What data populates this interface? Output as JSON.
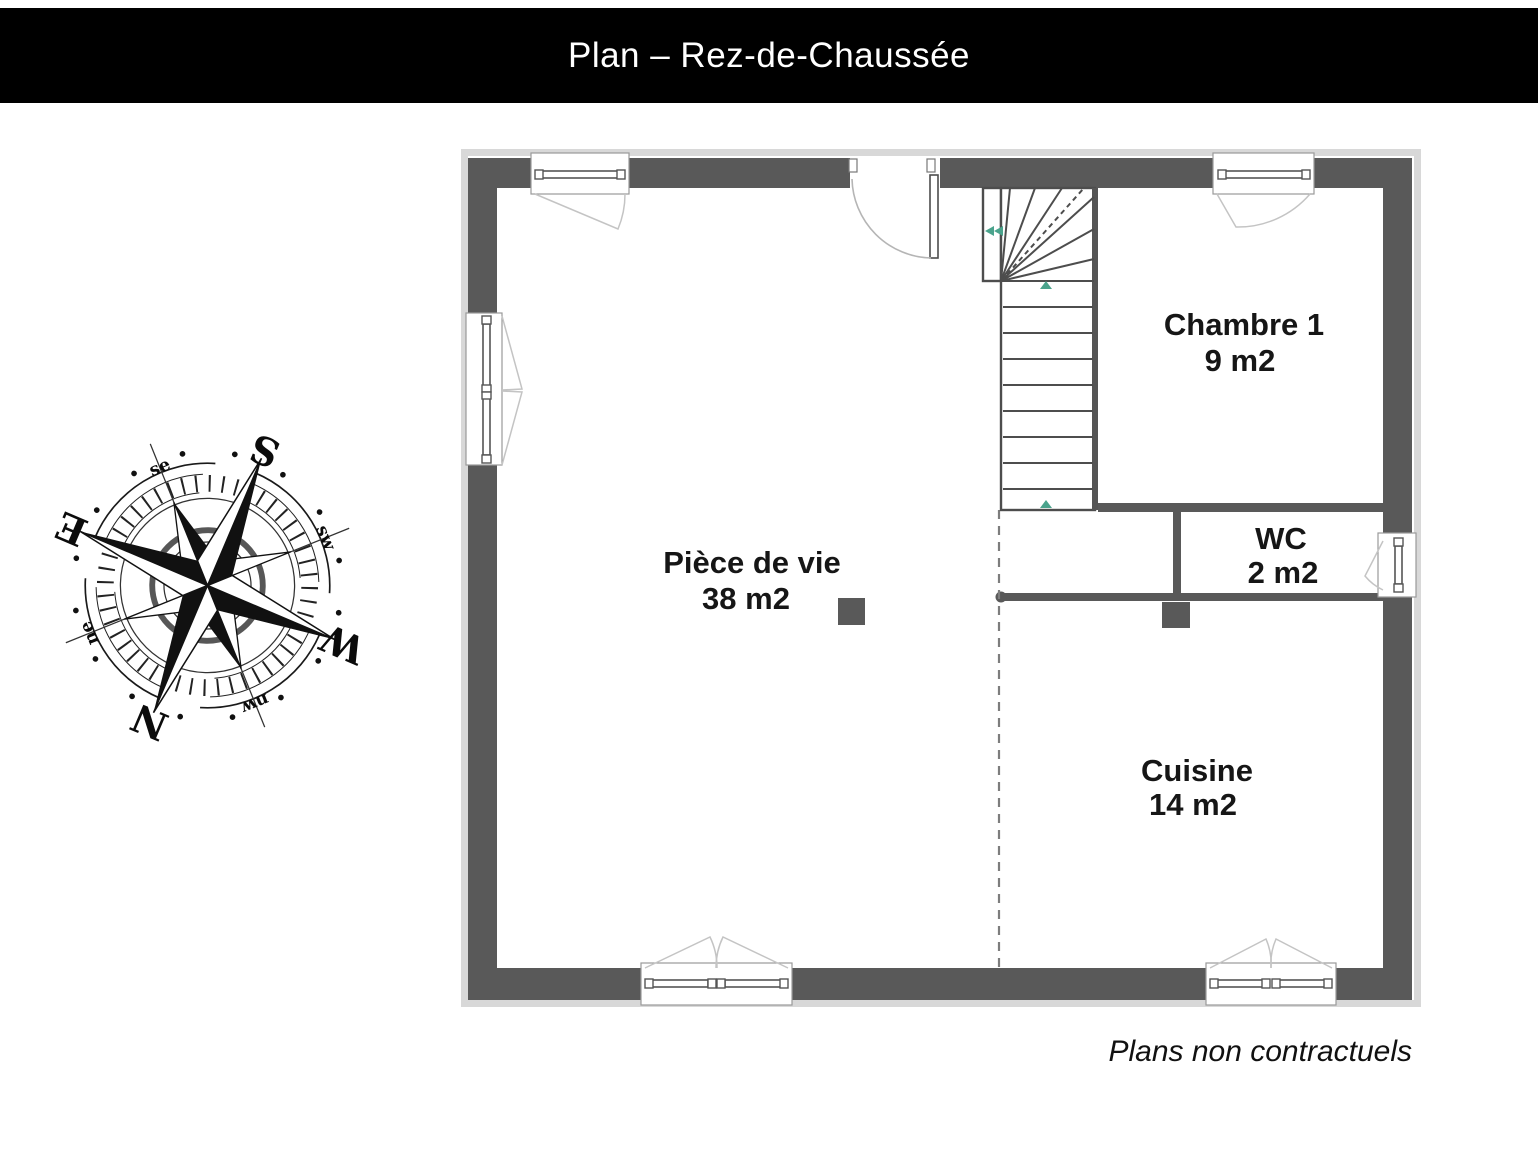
{
  "header": {
    "title": "Plan – Rez-de-Chaussée"
  },
  "compass": {
    "rotation_deg": 203,
    "cardinals": {
      "n": "N",
      "s": "S",
      "e": "E",
      "w": "W"
    },
    "intercardinals": {
      "ne": "ne",
      "se": "se",
      "sw": "sw",
      "nw": "nw"
    }
  },
  "rooms": [
    {
      "id": "piece-de-vie",
      "name": "Pièce de vie",
      "area": "38 m2"
    },
    {
      "id": "chambre-1",
      "name": "Chambre 1",
      "area": "9 m2"
    },
    {
      "id": "wc",
      "name": "WC",
      "area": "2 m2"
    },
    {
      "id": "cuisine",
      "name": "Cuisine",
      "area": "14 m2"
    }
  ],
  "footer": {
    "disclaimer": "Plans non contractuels"
  },
  "colors": {
    "header_bg": "#000000",
    "header_text": "#ffffff",
    "wall": "#595959",
    "plan_frame": "#d8d8d8",
    "stair_arrow": "#4aa38c",
    "swing_line": "#c4c4c4",
    "dashed_separator": "#7d7d7d"
  }
}
